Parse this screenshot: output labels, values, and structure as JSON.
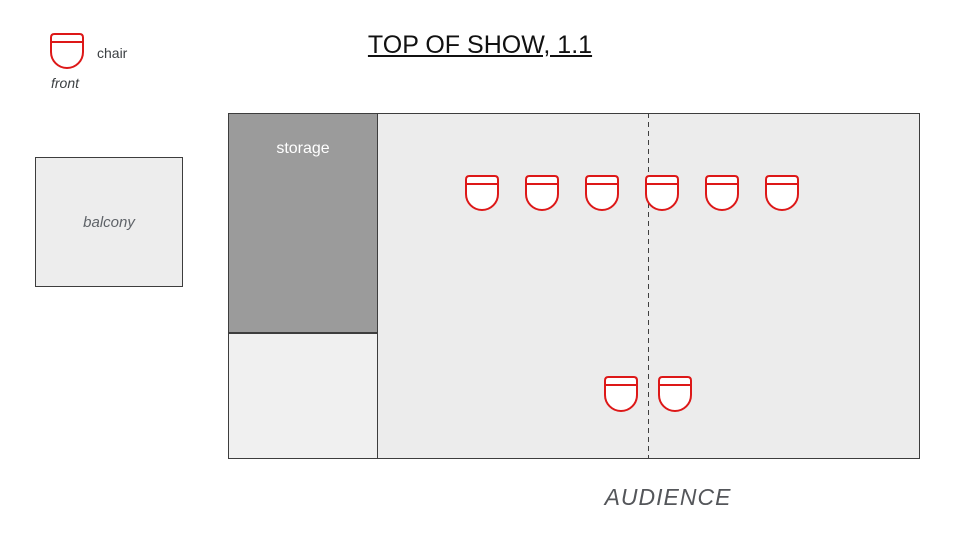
{
  "title": "TOP OF SHOW, 1.1",
  "legend": {
    "chair_label": "chair",
    "front_label": "front"
  },
  "balcony": {
    "label": "balcony"
  },
  "stage": {
    "storage_label": "storage",
    "center_line_x": 648,
    "chair_rows": [
      {
        "name": "upstage-row",
        "y": 174,
        "xs": [
          465,
          525,
          585,
          645,
          705,
          765
        ]
      },
      {
        "name": "downstage-pair",
        "y": 375,
        "xs": [
          604,
          658
        ]
      }
    ]
  },
  "audience_label": "AUDIENCE",
  "colors": {
    "chair_stroke": "#dd1818",
    "chair_fill": "#ffffff",
    "stage_fill": "#ececec",
    "storage_fill": "#9b9b9b",
    "balcony_fill": "#ededed",
    "under_storage_fill": "#f0f0f0",
    "outline": "#3d3d3d",
    "center_line": "#3f3f3f"
  }
}
